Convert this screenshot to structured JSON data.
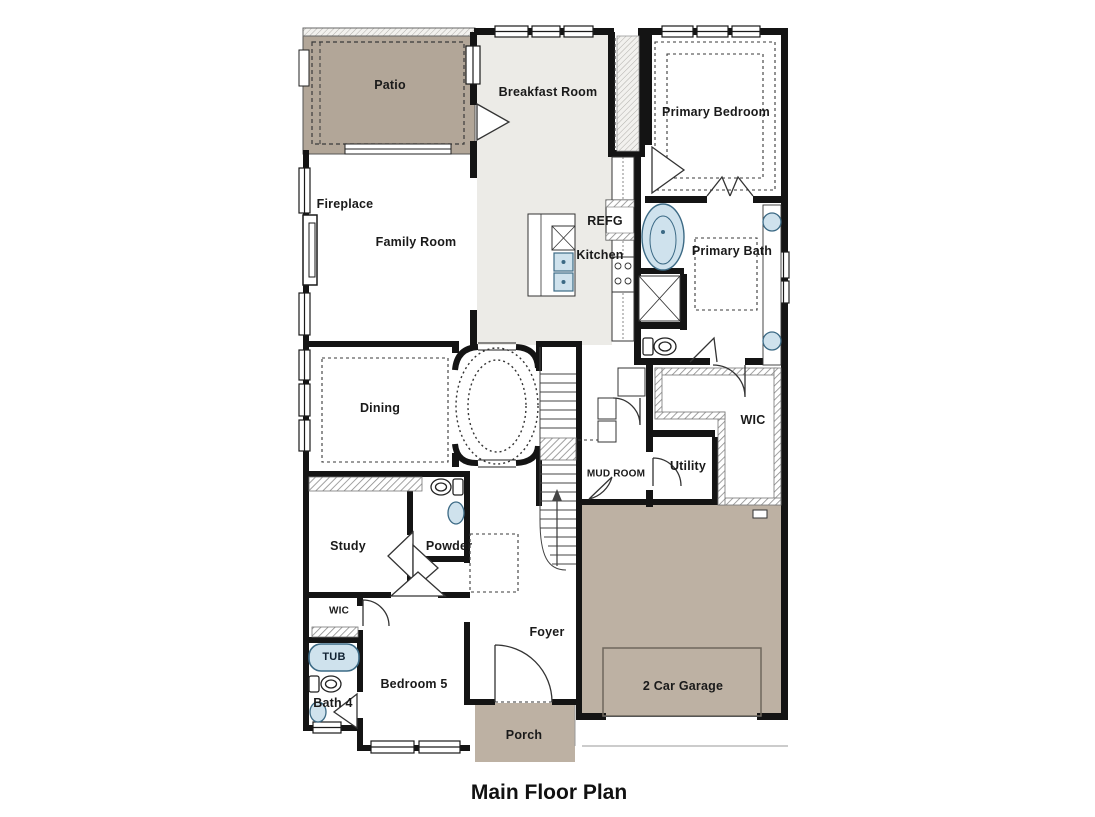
{
  "title": "Main Floor Plan",
  "rooms": {
    "patio": "Patio",
    "breakfast": "Breakfast Room",
    "primary_bedroom": "Primary Bedroom",
    "fireplace": "Fireplace",
    "family_room": "Family Room",
    "refg": "REFG",
    "kitchen": "Kitchen",
    "primary_bath": "Primary Bath",
    "dining": "Dining",
    "wic": "WIC",
    "mud_room": "MUD ROOM",
    "utility": "Utility",
    "study": "Study",
    "powder": "Powder",
    "wic_small": "WIC",
    "tub": "TUB",
    "bath4": "Bath 4",
    "bedroom5": "Bedroom 5",
    "foyer": "Foyer",
    "porch": "Porch",
    "garage": "2 Car Garage"
  },
  "colors": {
    "patio_fill": "#b2a698",
    "garage_fill": "#bdb1a3",
    "porch_fill": "#bdb1a3",
    "kitchen_zone_fill": "#ecebe7",
    "wall": "#141414",
    "fixture_fill": "#cfe2ed",
    "fixture_stroke": "#3c6a85",
    "dash_line": "#3a3a3a"
  }
}
